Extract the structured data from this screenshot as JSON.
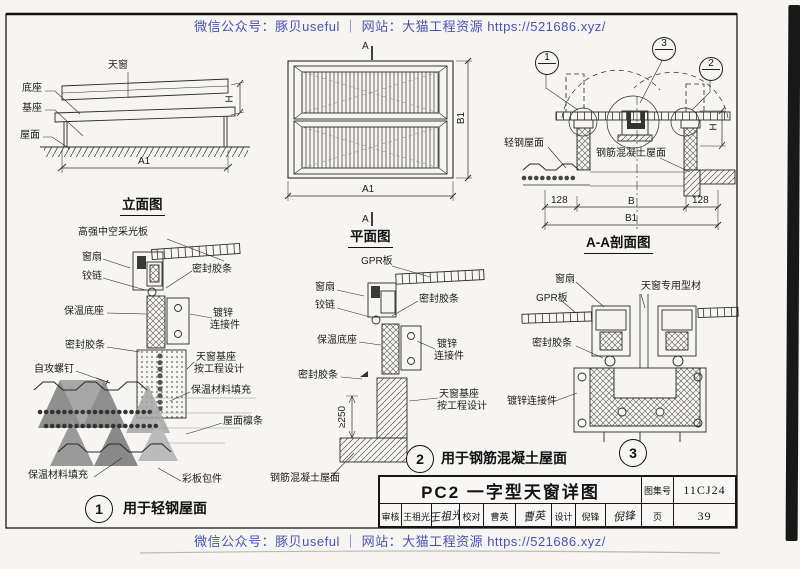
{
  "watermark": {
    "text": "微信公众号：豚贝useful ｜ 网站：大猫工程资源 https://521686.xyz/"
  },
  "colors": {
    "watermark": "#4a52b5",
    "ink": "#222222",
    "paper": "#f6f5f2"
  },
  "views": {
    "elevation": {
      "title": "立面图",
      "skylight": "天窗",
      "base": "底座",
      "pedestal": "基座",
      "roof": "屋面",
      "dim_a1": "A1",
      "dim_h": "H"
    },
    "plan": {
      "title": "平面图",
      "dim_a1": "A1",
      "dim_b1": "B1",
      "section_mark": "A"
    },
    "section": {
      "title": "A-A剖面图",
      "callout_1": "1",
      "callout_2": "2",
      "callout_3": "3",
      "light_steel_roof": "轻钢屋面",
      "concrete_roof": "钢筋混凝土屋面",
      "dim_128_left": "128",
      "dim_b": "B",
      "dim_128_right": "128",
      "dim_b1": "B1",
      "dim_h": "H"
    }
  },
  "detail1": {
    "num": "1",
    "caption": "用于轻钢屋面",
    "labels": {
      "glazing_panel": "高强中空采光板",
      "sash": "窗扇",
      "hinge": "铰链",
      "seal_top": "密封胶条",
      "insulated_base": "保温底座",
      "galv_connector_1": "镀锌",
      "galv_connector_2": "连接件",
      "seal_bottom": "密封胶条",
      "self_tapping_screw": "自攻螺钉",
      "skylight_base_1": "天窗基座",
      "skylight_base_2": "按工程设计",
      "insulation_fill_right": "保温材料填充",
      "roof_purlin": "屋面檩条",
      "insulation_fill_left": "保温材料填充",
      "color_plate": "彩板包件"
    }
  },
  "detail2": {
    "num": "2",
    "caption": "用于钢筋混凝土屋面",
    "labels": {
      "gpr_panel": "GPR板",
      "sash": "窗扇",
      "hinge": "铰链",
      "seal_top": "密封胶条",
      "insulated_base": "保温底座",
      "galv_connector_1": "镀锌",
      "galv_connector_2": "连接件",
      "seal_bottom": "密封胶条",
      "skylight_base_1": "天窗基座",
      "skylight_base_2": "按工程设计",
      "concrete_roof": "钢筋混凝土屋面",
      "dim_250": "≥250"
    }
  },
  "detail3": {
    "num": "3",
    "labels": {
      "sash": "窗扇",
      "special_profile": "天窗专用型材",
      "gpr_panel": "GPR板",
      "seal": "密封胶条",
      "galv_connector": "镀锌连接件"
    }
  },
  "titleblock": {
    "title": "PC2  一字型天窗详图",
    "atlas_label": "图集号",
    "atlas_no": "11CJ24",
    "page_label": "页",
    "page_no": "39",
    "reviewer_label": "审核",
    "reviewer": "王祖光",
    "reviewer_sig": "王祖光",
    "checker_label": "校对",
    "checker": "曹英",
    "checker_sig": "曹英",
    "designer_label": "设计",
    "designer": "倪锋",
    "designer_sig": "倪锋"
  }
}
